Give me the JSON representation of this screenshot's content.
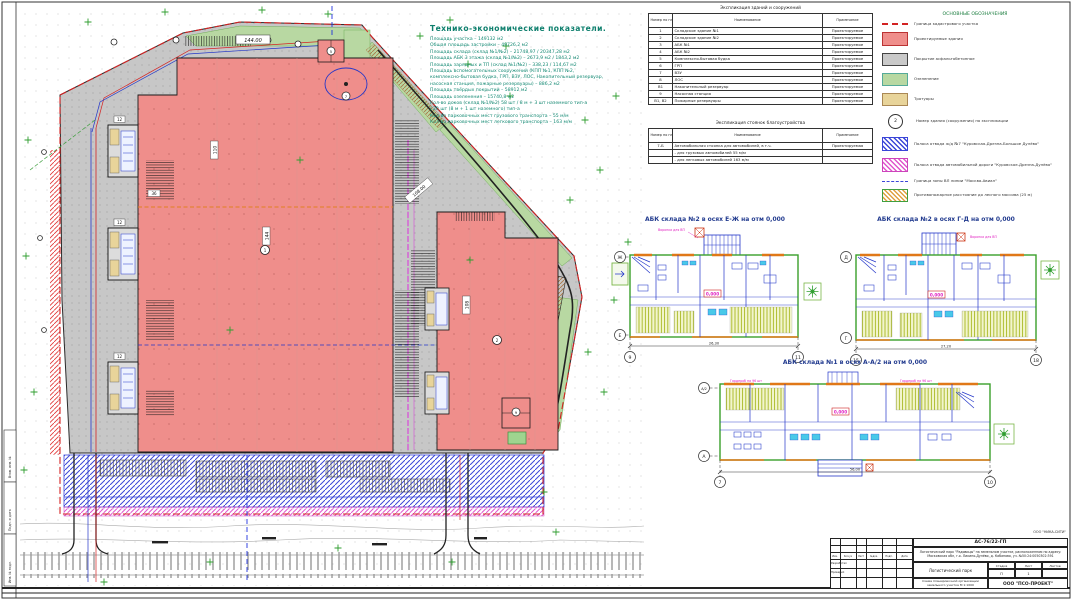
{
  "tep": {
    "title": "Технико-экономические показатели.",
    "lines": [
      "Площадь участка  – 149132 м2",
      "Общая площадь застройки   – 49726,2 м2",
      "Площадь склада (склад №1/№2)  – 21748,97 / 20347,28  м2",
      "Площадь АБК 3 этажа (склад №1/№2)   – 2673,9 м2 / 1843,2 м2",
      "Площадь зарядных и ТП (склад №1/№2)  – 338,23 / 114,67 м2",
      "Площадь вспомогательных сооружений (КПП №1, КПП №2,",
      "комплексно-бытовая будка, ГРП, ВЗУ, ЛОС, Накопительный резервуар,",
      "насосная станция, пожарные резервуары)  – 886,2 м2",
      "Площадь твёрдых покрытий  – 58912 м2",
      "Площадь озеленения  – 15740,8 м2",
      "Кол-во доков (склад №1/№2) 58 шт / 8 м + 3 шт наземного тип-а",
      "/ 20 шт (8 м + 1 шт наземного) тип-а",
      "Кол-во парковочных мест грузового транспорта – 55 м/м",
      "Кол-во парковочных мест легкового транспорта – 163 м/м"
    ]
  },
  "tables": {
    "buildings": {
      "title": "Экспликация зданий и сооружений",
      "headers": [
        "Номер по плану",
        "Наименование",
        "Примечание"
      ],
      "rows": [
        [
          "1",
          "Складское здание №1",
          "Проектируемое"
        ],
        [
          "2",
          "Складское здание №2",
          "Проектируемое"
        ],
        [
          "3",
          "АБК №1",
          "Проектируемое"
        ],
        [
          "4",
          "АБК №2",
          "Проектируемое"
        ],
        [
          "5",
          "Комплексно-бытовая будка",
          "Проектируемое"
        ],
        [
          "6",
          "ГРП",
          "Проектируемое"
        ],
        [
          "7",
          "ВЗУ",
          "Проектируемое"
        ],
        [
          "8",
          "ЛОС",
          "Проектируемое"
        ],
        [
          "В1",
          "Накопительный резервуар",
          "Проектируемое"
        ],
        [
          "9",
          "Насосная станция",
          "Проектируемое"
        ],
        [
          "В1, В2",
          "Пожарные резервуары",
          "Проектируемое"
        ]
      ]
    },
    "parking": {
      "title": "Экспликация стоянок благоустройства",
      "headers": [
        "Номер по плану",
        "Наименование",
        "Примечание"
      ],
      "rows": [
        [
          "7-Б",
          "Автомобильная стоянка для автомобилей, в т.ч.",
          "Проектируемая"
        ],
        [
          "",
          "- для грузовых автомобилей 55 м/м",
          ""
        ],
        [
          "",
          "- для легковых автомобилей 163 м/м",
          ""
        ]
      ]
    }
  },
  "legend": {
    "title": "ОСНОВНЫЕ ОБОЗНАЧЕНИЯ",
    "number_example": "2",
    "items": [
      "Граница кадастрового участка",
      "Проектируемые здания",
      "Покрытие асфальтобетонное",
      "Озеленение",
      "Тротуары",
      "Номер здания (сооружения) по экспликации",
      "Полоса отвода ж/д №7 \"Куровская-Дрезна-Большое Дулёво\"",
      "Полоса отвода автомобильной дороги \"Куровское-Дрезна-Дулёво\"",
      "Граница зоны ВЛ линии \"Москва-Авиал\"",
      "Противопожарное расстояние до лесного массива (25 м)"
    ]
  },
  "plans": [
    {
      "title": "АБК склада №2 в осях Е-Ж на отм 0,000",
      "axis_tl": "Ж",
      "axis_bl": "Е",
      "grid_l": "9",
      "grid_r": "11",
      "dim": "26,30",
      "level": "0,000",
      "note": "Воронка для ВП"
    },
    {
      "title": "АБК склада №2 в осях Г-Д на отм 0,000",
      "axis_tl": "Д",
      "axis_bl": "Г",
      "grid_l": "15",
      "grid_r": "18",
      "dim": "27,20",
      "level": "0,000",
      "note": "Воронка для ВП"
    },
    {
      "title": "АБК склада №1 в осях А-А/2 на отм 0,000",
      "axis_tl": "А/2",
      "axis_bl": "А",
      "grid_l": "7",
      "grid_r": "10",
      "dim": "56,00",
      "level": "0,000",
      "note": "Гардероб на 96 шт"
    }
  ],
  "site": {
    "dim_top": "144.00",
    "dim_right": "108.00",
    "dim_b1_v": "144",
    "dim_b1_h": "110",
    "dim_b2": "108",
    "dim_dock": "12",
    "dim_gap": "36",
    "bubbles": [
      "1",
      "2",
      "5",
      "7",
      "9"
    ]
  },
  "sheet": {
    "side_labels": [
      "Взам. инв. №",
      "Подп. и дата",
      "Инв. № подл."
    ]
  },
  "titleblock": {
    "corner_ref": "ООО \"НИКА-СИТИ\"",
    "doc_number": "АС-76/22-ГП",
    "description": "Логистический парк \"Радовицы\" на земельном участке, расположенном по адресу: Московская обл, г.о. Ликино-Дулёво, д. Кабаново, уч. №50:24:0050302:391",
    "object_name": "Логистический парк",
    "sheet_title": "Схема планировочной организации земельного участка М 1:1000",
    "stage_headers": [
      "Стадия",
      "Лист",
      "Листов"
    ],
    "stage": "П",
    "sheet_num": "1",
    "sheets_total": "",
    "sig_headers": [
      "Изм.",
      "Кол.уч",
      "Лист",
      "№док.",
      "Подп.",
      "Дата"
    ],
    "roles": [
      "Разработал",
      "Проверил"
    ],
    "company": "ООО \"ПСО-ПРОЕКТ\""
  }
}
